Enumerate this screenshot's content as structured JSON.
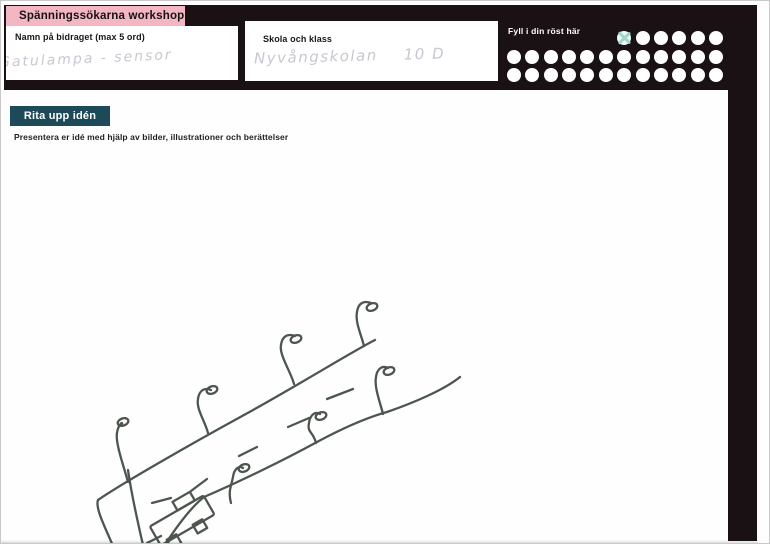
{
  "document": {
    "type": "scanned workshop worksheet"
  },
  "header": {
    "title": "Spänningssökarna workshop",
    "name_field": {
      "label": "Namn på bidraget (max 5 ord)",
      "value": "Gatulampa - sensor"
    },
    "school_field": {
      "label": "Skola och klass",
      "value_school": "Nyvångskolan",
      "value_class": "10 D"
    },
    "vote": {
      "label": "Fyll i din röst här",
      "grid": {
        "rows": 3,
        "cols": 12,
        "top_row_starts_at_col": 7
      },
      "marked_dot": {
        "row": 1,
        "col": 7,
        "mark": "X"
      }
    }
  },
  "section": {
    "heading": "Rita upp idén",
    "instruction": "Presentera er idé med hjälp av bilder, illustrationer och berättelser"
  },
  "sketch": {
    "description": "Pencil drawing of a road running diagonally up to the right with a dashed centre line, seven hook-topped street lamps along both road edges and a small car at the bottom left",
    "road_paths": [
      "M112,545 C104,526 94,507 97,499 C120,483 190,443 243,414 C296,385 352,350 374,339",
      "M163,545 C180,519 194,503 203,496 C238,481 283,459 316,441 C344,426 368,416 386,411 C412,402 443,389 459,376",
      "M127,469 C130,490 136,518 142,544"
    ],
    "dashes": [
      [
        190,
        490,
        206,
        478
      ],
      [
        238,
        455,
        256,
        446
      ],
      [
        287,
        426,
        308,
        417
      ],
      [
        326,
        398,
        352,
        388
      ],
      [
        151,
        502,
        170,
        497
      ],
      [
        146,
        542,
        160,
        535
      ]
    ],
    "lamps": [
      {
        "bx": 127,
        "by": 481,
        "tx": 116,
        "ty": 424,
        "hx": 122,
        "hy": 421
      },
      {
        "bx": 207,
        "by": 432,
        "tx": 197,
        "ty": 390,
        "hx": 211,
        "hy": 389
      },
      {
        "bx": 293,
        "by": 383,
        "tx": 280,
        "ty": 336,
        "hx": 295,
        "hy": 338
      },
      {
        "bx": 363,
        "by": 345,
        "tx": 356,
        "ty": 303,
        "hx": 371,
        "hy": 306
      },
      {
        "bx": 230,
        "by": 502,
        "tx": 232,
        "ty": 468,
        "hx": 243,
        "hy": 467
      },
      {
        "bx": 315,
        "by": 442,
        "tx": 308,
        "ty": 414,
        "hx": 320,
        "hy": 415
      },
      {
        "bx": 382,
        "by": 413,
        "tx": 375,
        "ty": 368,
        "hx": 388,
        "hy": 370
      }
    ],
    "car": {
      "cx": 182,
      "cy": 519,
      "angle": -30
    }
  },
  "colors": {
    "band_black": "#191114",
    "pink": "#f4b6c3",
    "petrol": "#1c4a59",
    "ink": "#4c564f",
    "pencil": "#c9c7cf",
    "vote_mark": "#9fd6cc",
    "paper": "#fefefe"
  }
}
